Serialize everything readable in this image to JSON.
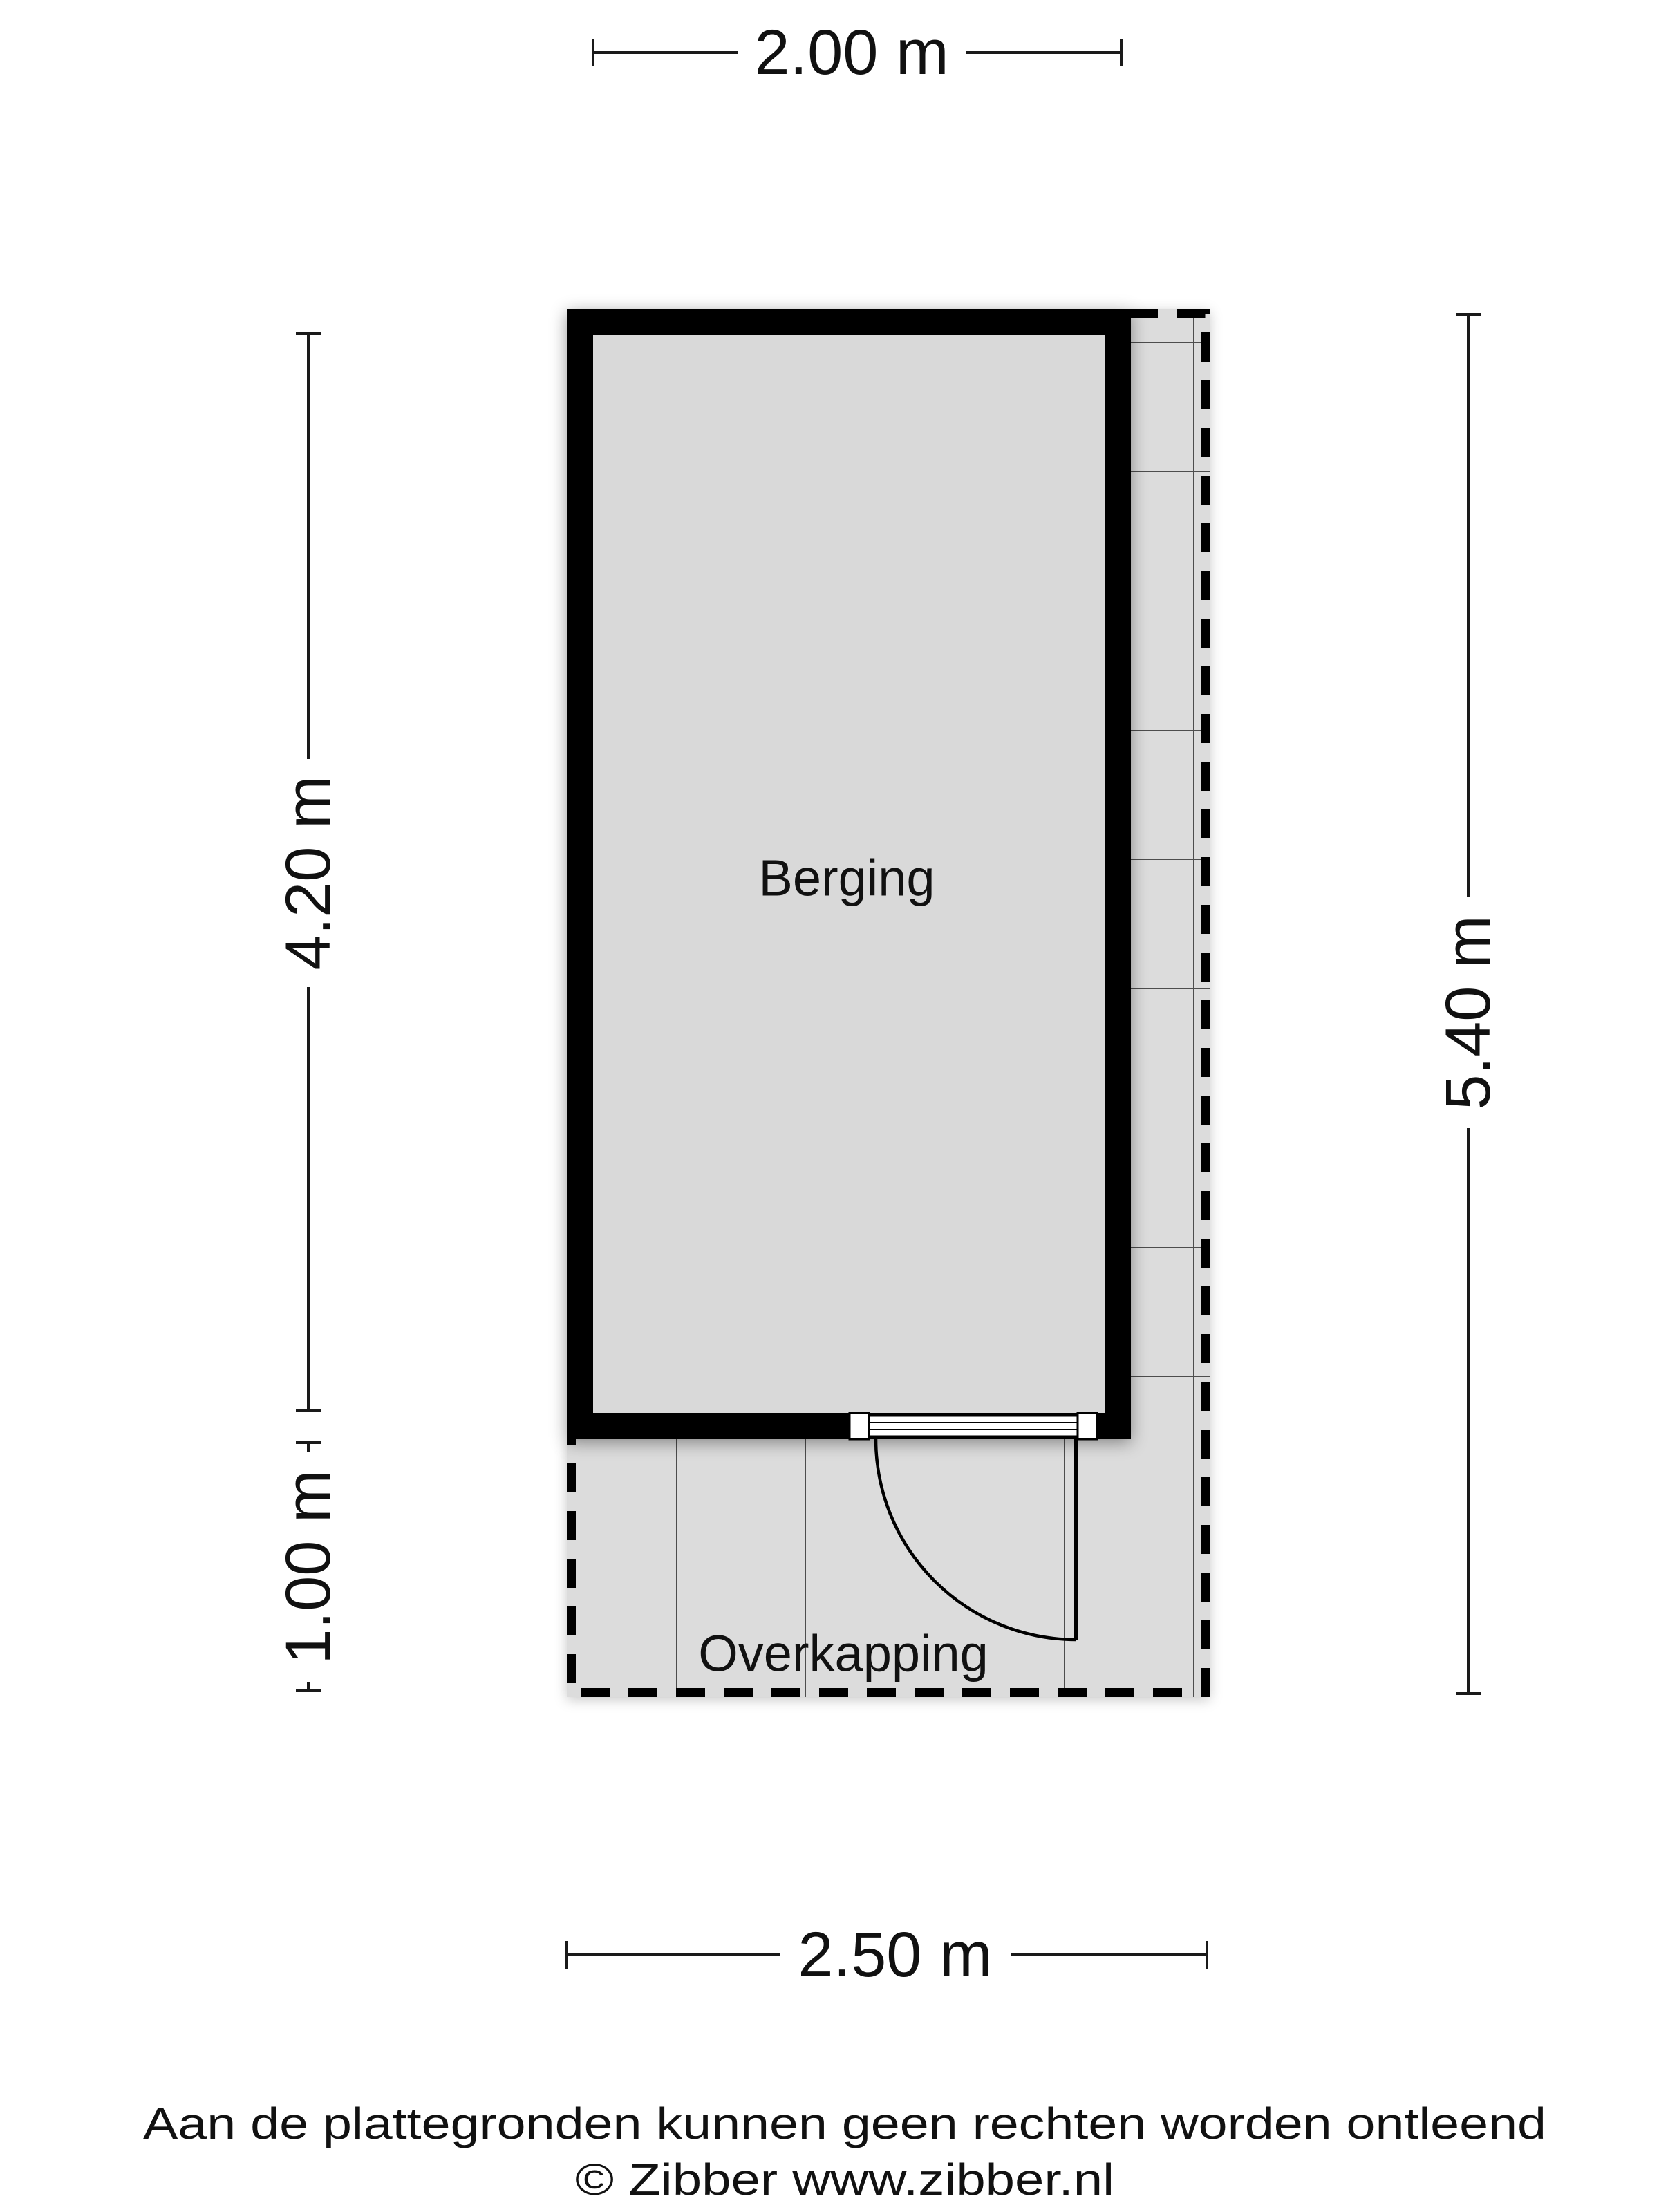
{
  "plan": {
    "rooms": [
      {
        "label": "Berging"
      },
      {
        "label": "Overkapping"
      }
    ],
    "dimensions": {
      "top": "2.00 m",
      "left_upper": "4.20 m",
      "left_lower": "1.00 m",
      "right": "5.40 m",
      "bottom": "2.50 m"
    },
    "colors": {
      "wall": "#000000",
      "room_fill": "#d9d9d9",
      "paved_fill": "#dcdcdc",
      "grid_line": "#4d4d4d",
      "line_color": "#1a1a1a",
      "text_color": "#111111"
    }
  },
  "footer": {
    "disclaimer": "Aan de plattegronden kunnen geen rechten worden ontleend",
    "credit": "© Zibber www.zibber.nl"
  }
}
